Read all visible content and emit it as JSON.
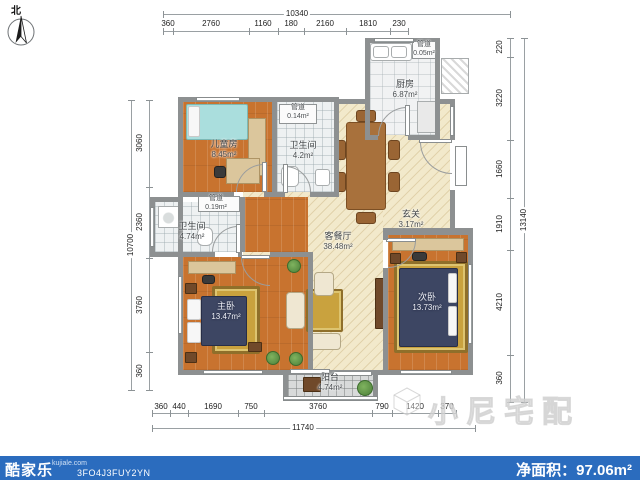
{
  "compass": {
    "label": "北"
  },
  "rooms": {
    "kitchen": {
      "name": "厨房",
      "area": "6.87m²"
    },
    "kitchen_duct": {
      "name": "管道",
      "area": "0.05m²"
    },
    "children": {
      "name": "儿童房",
      "area": "8.45m²"
    },
    "bath_top": {
      "name": "卫生间",
      "area": "4.2m²"
    },
    "duct_top": {
      "name": "管道",
      "area": "0.14m²"
    },
    "bath_left": {
      "name": "卫生间",
      "area": "4.74m²"
    },
    "duct_left": {
      "name": "管道",
      "area": "0.19m²"
    },
    "living": {
      "name": "客餐厅",
      "area": "38.48m²"
    },
    "entry": {
      "name": "玄关",
      "area": "3.17m²"
    },
    "master": {
      "name": "主卧",
      "area": "13.47m²"
    },
    "second": {
      "name": "次卧",
      "area": "13.73m²"
    },
    "balcony": {
      "name": "阳台",
      "area": "4.74m²"
    }
  },
  "dims": {
    "top": {
      "total": "10340",
      "segments": [
        "360",
        "2760",
        "1160",
        "180",
        "2160",
        "1810",
        "230"
      ]
    },
    "right": {
      "total": "13140",
      "segments": [
        "220",
        "3220",
        "1660",
        "1910",
        "4210",
        "360"
      ]
    },
    "left": {
      "total": "10700",
      "segments": [
        "3060",
        "2360",
        "3760",
        "360"
      ]
    },
    "bottom": {
      "total": "11740",
      "segments": [
        "360",
        "440",
        "1690",
        "750",
        "3760",
        "790",
        "1420",
        "370"
      ]
    }
  },
  "watermark": {
    "text": "小尼宅配"
  },
  "footer": {
    "brand": "酷家乐",
    "site": "kujiale.com",
    "code": "3FO4J3FUY2YN",
    "net_label": "净面积：",
    "net_value": "97.06m²"
  }
}
